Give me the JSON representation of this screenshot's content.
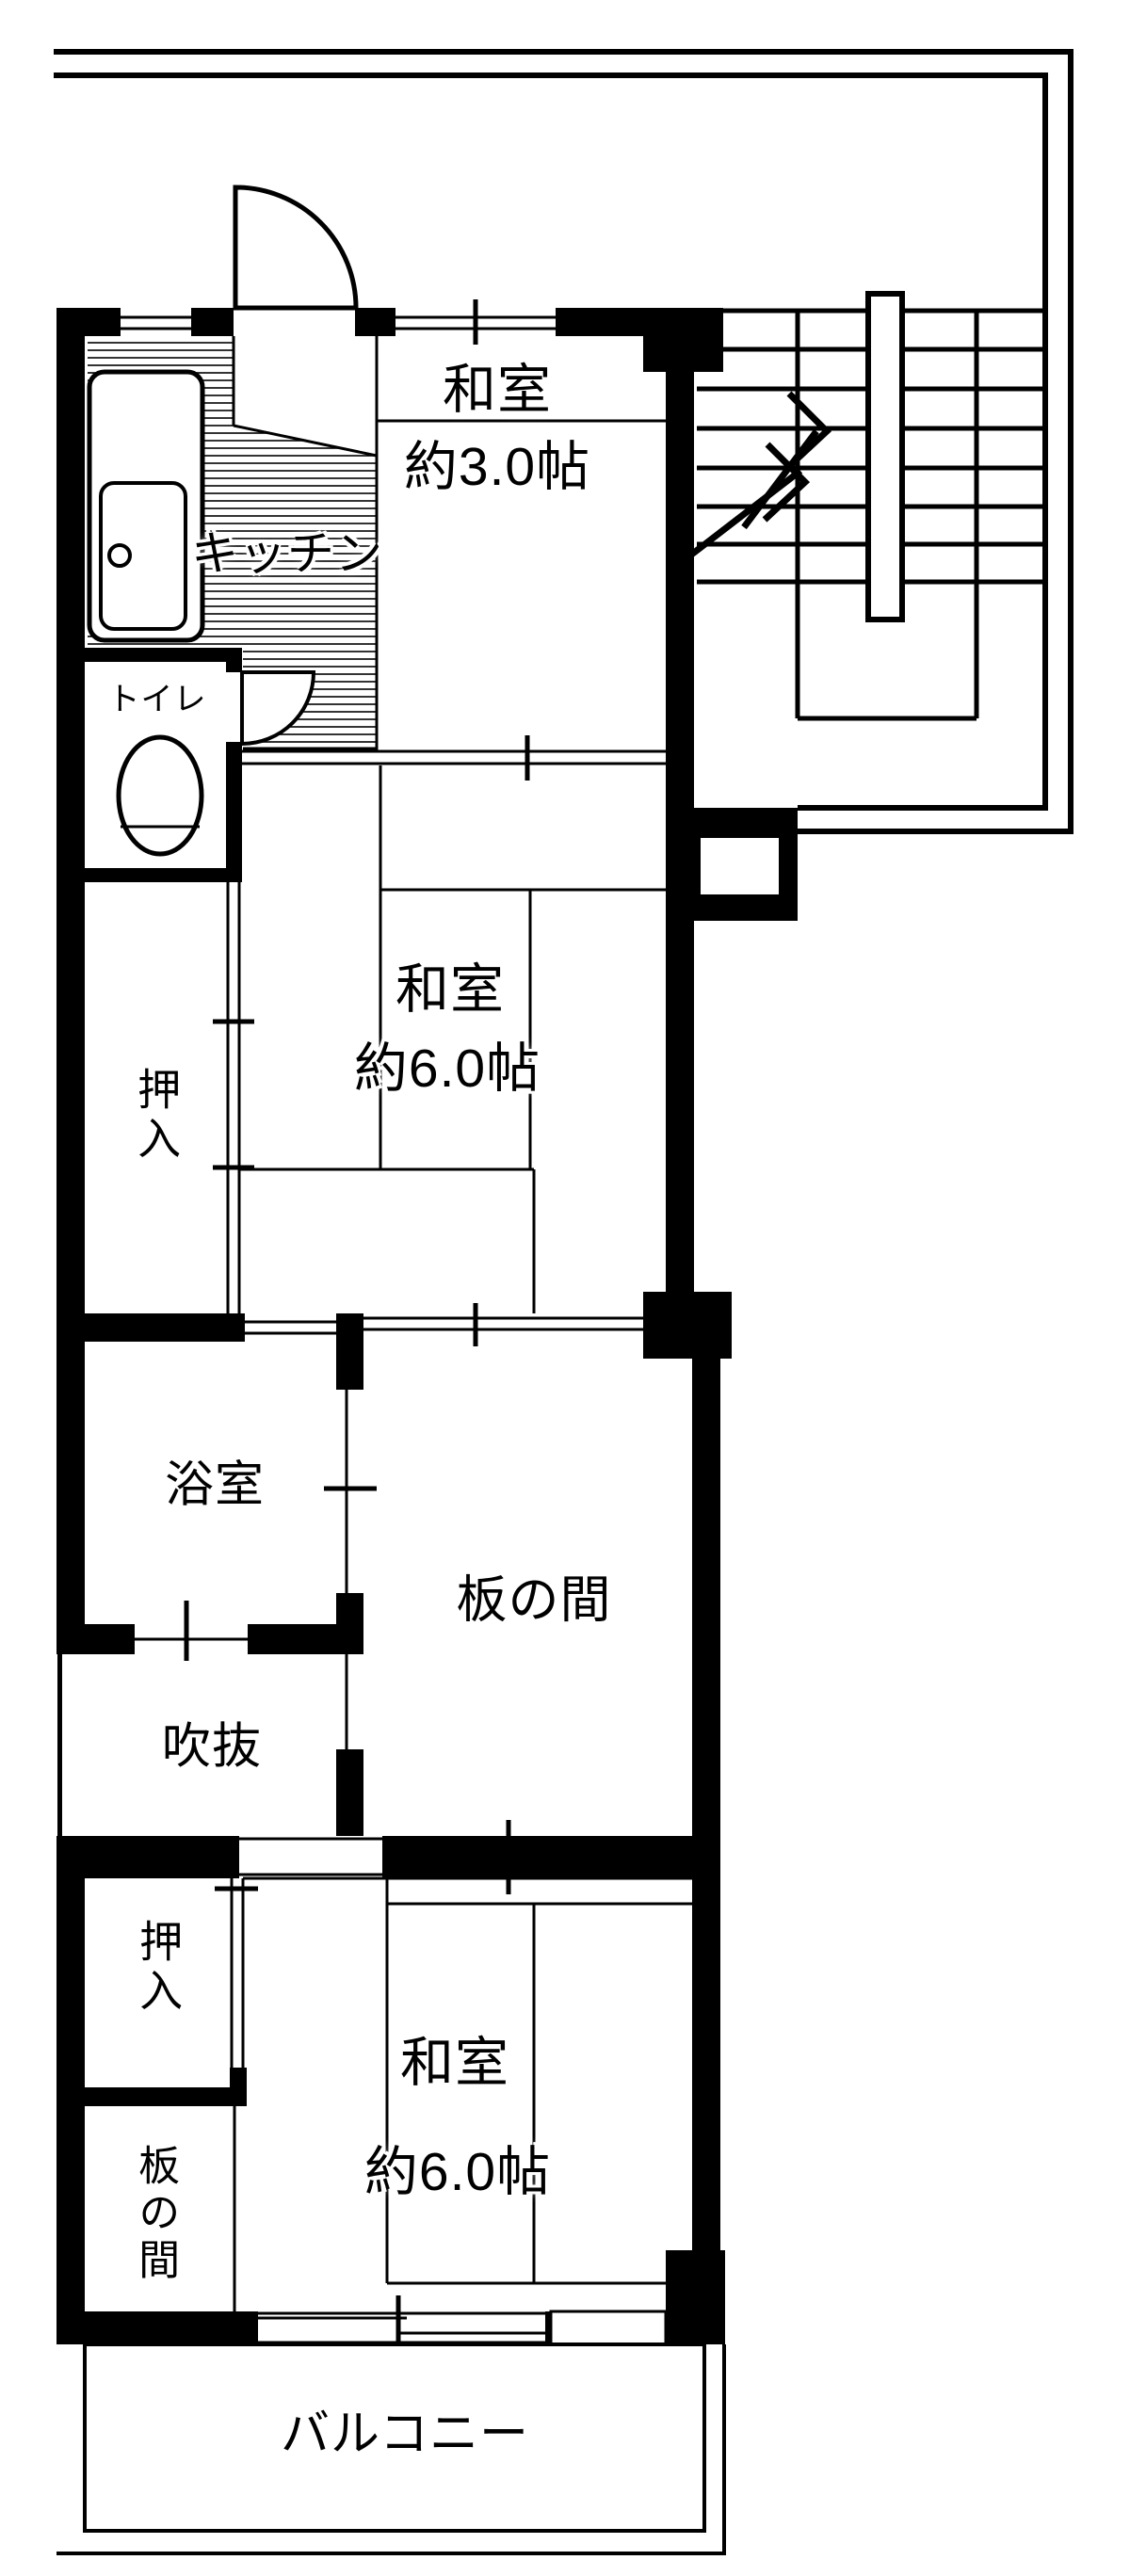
{
  "plan": {
    "rooms": {
      "kitchen": {
        "label": "キッチン"
      },
      "washitsu_upper": {
        "label": "和室",
        "size": "約3.0帖"
      },
      "washitsu_middle": {
        "label": "和室",
        "size": "約6.0帖"
      },
      "washitsu_lower": {
        "label": "和室",
        "size": "約6.0帖"
      },
      "toilet": {
        "label": "トイレ"
      },
      "closet_upper": {
        "label": "押入"
      },
      "bathroom": {
        "label": "浴室"
      },
      "open_void": {
        "label": "吹抜"
      },
      "itanoma_center": {
        "label": "板の間"
      },
      "closet_lower": {
        "label": "押入"
      },
      "itanoma_lower": {
        "label": "板の間"
      },
      "balcony": {
        "label": "バルコニー"
      }
    },
    "colors": {
      "wall": "#000000",
      "background": "#ffffff"
    }
  }
}
